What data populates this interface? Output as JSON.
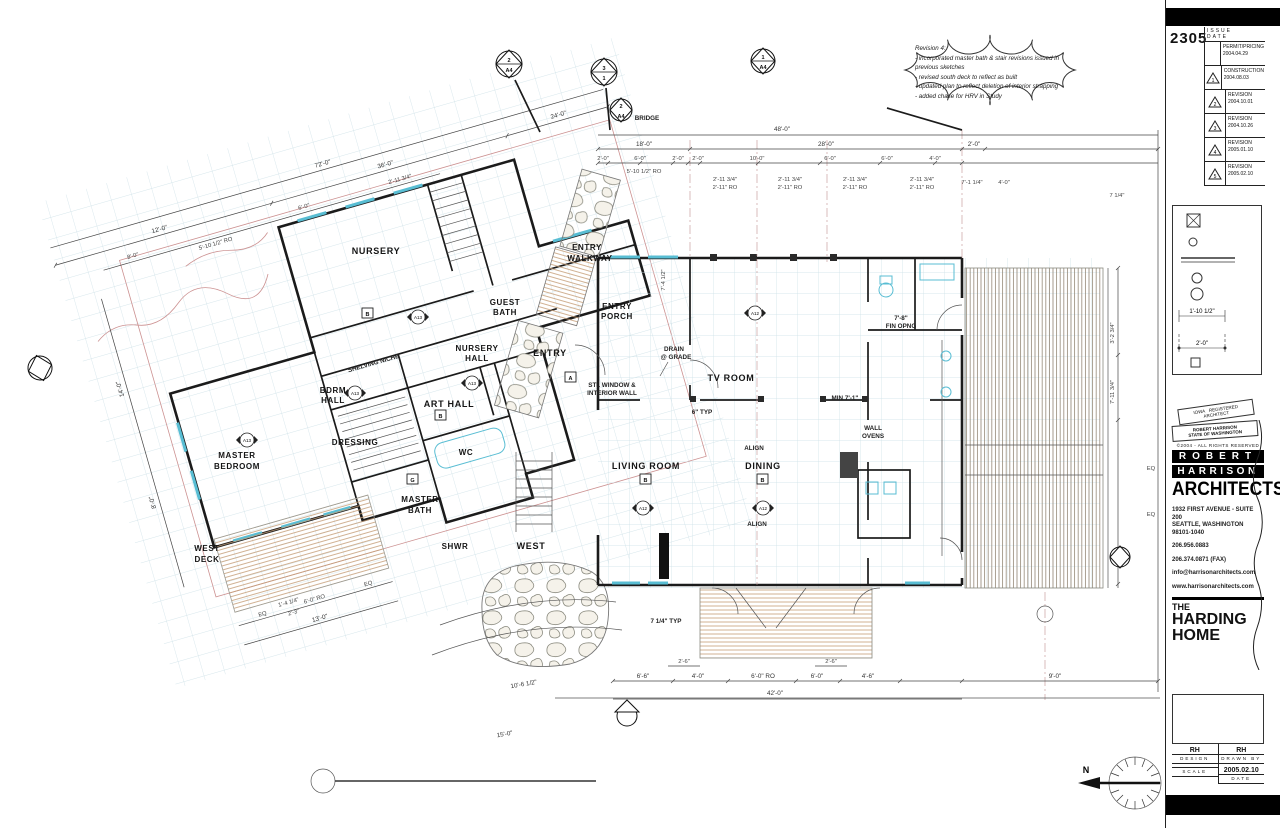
{
  "sheet": {
    "project_number": "2305"
  },
  "revision_table": {
    "headers": {
      "no": "NO.",
      "issue": "ISSUE",
      "date": "DATE"
    },
    "rows": [
      {
        "no": "",
        "issue": "PERMIT/PRICING",
        "date": "2004.04.29"
      },
      {
        "no": "1",
        "issue": "CONSTRUCTION",
        "date": "2004.08.03"
      },
      {
        "no": "2",
        "issue": "REVISION",
        "date": "2004.10.01"
      },
      {
        "no": "3",
        "issue": "REVISION",
        "date": "2004.10.26"
      },
      {
        "no": "4",
        "issue": "REVISION",
        "date": "2005.01.10"
      },
      {
        "no": "5",
        "issue": "REVISION",
        "date": "2005.02.10"
      }
    ]
  },
  "legend": {
    "dim_a": "1'-10 1/2\"",
    "dim_b": "2'-0\""
  },
  "stamp": {
    "line1": "IOWA",
    "line2": "REGISTERED",
    "line3": "ARCHITECT",
    "name": "ROBERT HARRISON",
    "state": "STATE OF WASHINGTON",
    "copyright": "©2004 - ALL RIGHTS RESERVED"
  },
  "firm": {
    "bar1": "ROBERT",
    "bar2": "HARRISON",
    "bar3": "ARCHITECTS",
    "addr1": "1932 FIRST AVENUE - SUITE 200",
    "addr2": "SEATTLE, WASHINGTON",
    "addr3": "98101-1040",
    "phone": "206.956.0883",
    "fax": "206.374.0871 (FAX)",
    "email": "info@harrisonarchitects.com",
    "web": "www.harrisonarchitects.com"
  },
  "project": {
    "t1": "THE",
    "t2": "HARDING",
    "t3": "HOME"
  },
  "fields": {
    "design_v": "RH",
    "design_l": "DESIGN",
    "drawn_v": "RH",
    "drawn_l": "DRAWN BY",
    "scale_l": "SCALE",
    "scale_v": "",
    "date_v": "2005.02.10",
    "date_l": "DATE"
  },
  "cloud": {
    "title": "Revision 4:",
    "l1": "- incorporated master bath & stair revisions issued in previous sketches",
    "l2": "- revised south deck to reflect as built",
    "l3": "- updated plan to reflect deletion of interior strapping",
    "l4": "- added chase for HRV in Study"
  },
  "rooms": {
    "nursery": "NURSERY",
    "guest_bath": [
      "GUEST",
      "BATH"
    ],
    "nursery_hall": [
      "NURSERY",
      "HALL"
    ],
    "entry": "ENTRY",
    "entry_walkway": [
      "ENTRY",
      "WALKWAY"
    ],
    "entry_porch": [
      "ENTRY",
      "PORCH"
    ],
    "bdrm_hall": [
      "BDRM",
      "HALL"
    ],
    "art_hall": "ART HALL",
    "dressing": "DRESSING",
    "wc": "WC",
    "master_bedroom": [
      "MASTER",
      "BEDROOM"
    ],
    "master_bath": [
      "MASTER",
      "BATH"
    ],
    "shwr": "SHWR",
    "west_deck": [
      "WEST",
      "DECK"
    ],
    "west": "WEST",
    "tv_room": "TV ROOM",
    "living_room": "LIVING ROOM",
    "dining": "DINING"
  },
  "ann": {
    "stl1": "STL WINDOW &",
    "stl2": "INTERIOR WALL",
    "drain1": "DRAIN",
    "drain2": "@ GRADE",
    "ovens1": "WALL",
    "ovens2": "OVENS",
    "shelving": "SHELVING NICHE",
    "align": "ALIGN",
    "min": "MIN 7'-1\"",
    "fin1": "7'-8\"",
    "fin2": "FIN OPNG",
    "typ714": "7 1/4\" TYP",
    "typ6": "6\" TYP",
    "bridge": "BRIDGE"
  },
  "dims": {
    "e_total": "48'-0\"",
    "e_row2": [
      "18'-0\"",
      "28'-0\"",
      "2'-0\""
    ],
    "e_row3": [
      "2'-0\"",
      "6'-0\"",
      "2'-0\"",
      "2'-0\"",
      "10'-0\"",
      "6'-0\"",
      "6'-0\"",
      "4'-0\""
    ],
    "ro_a": "2'-11 3/4\"",
    "ro_b": "2'-11\" RO",
    "ro_c": "5'-10 1/2\" RO",
    "tr_a": "7'-1 1/4\"",
    "tr_b": "4'-0\"",
    "tr_c": "7 1/4\"",
    "tv_a": "7'-4 1/2\"",
    "w_total": "72'-0\"",
    "w_row2": [
      "12'-0\"",
      "36'-0\"",
      "24'-0\""
    ],
    "w_row3": [
      "8'-0\"",
      "5'-10 1/2\" RO",
      "6'-0\"",
      "2'-11 3/4\""
    ],
    "w_left": [
      "14'-0\"",
      "8'-0\""
    ],
    "s_row": [
      "6'-6\"",
      "4'-0\"",
      "6'-0\" RO",
      "6'-0\"",
      "4'-6\"",
      "9'-0\""
    ],
    "s_total": "42'-0\"",
    "s_small": "2'-6\"",
    "rv_a": "3'-2 3/4\"",
    "rv_b": "7'-11 3/4\"",
    "eq": "EQ",
    "deck": [
      "EQ",
      "6'-0\" RO",
      "EQ",
      "13'-0\"",
      "10'-6 1/2\"",
      "15'-0\""
    ],
    "misc_a": "1'-4 1/4\"",
    "misc_b": "2'-3\""
  },
  "markers": {
    "m1": "2",
    "m2": "3",
    "m3": "1",
    "m4": "2",
    "sheet": "A4"
  },
  "keynotes": {
    "b": "B",
    "a": "A",
    "g": "G"
  },
  "diamonds": {
    "d1": "A12",
    "d2": "A13"
  },
  "compass": {
    "n": "N"
  }
}
